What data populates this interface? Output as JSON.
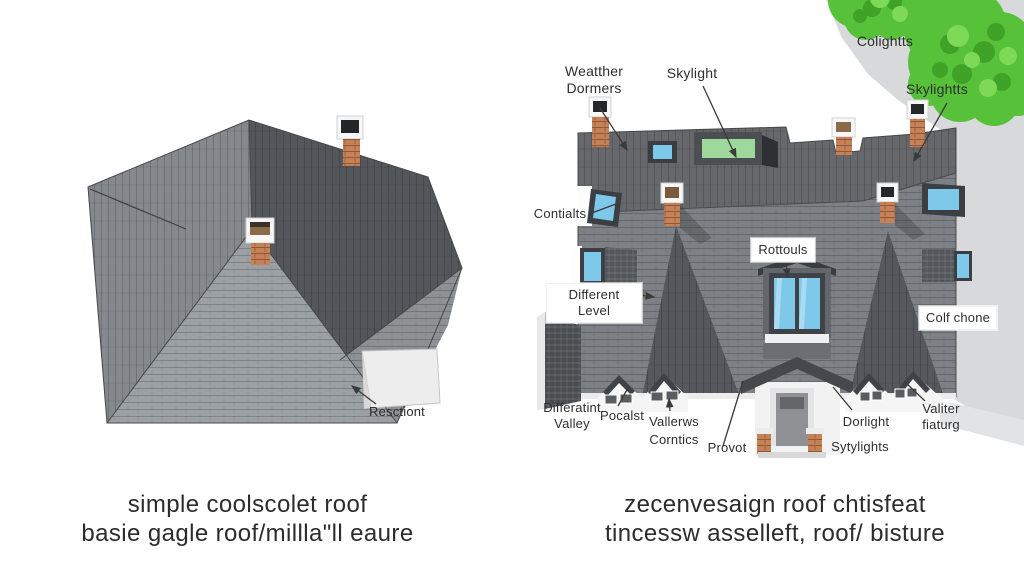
{
  "colors": {
    "background": "#ffffff",
    "roof_dark": "#54575b",
    "roof_medium": "#7d8084",
    "roof_light": "#9aa0a4",
    "roof_top_band": "#66686b",
    "chimney_brick": "#c58157",
    "window_blue": "#7ec8ea",
    "skylight_green": "#9fd89b",
    "tree_green": "#58c13a",
    "backdrop_gray": "#d8d9da",
    "label_text": "#2e2e2e"
  },
  "left_panel": {
    "annotation_resctiont": "Resctiont",
    "caption": [
      "simple coolscolet roof",
      "basie gagle roof/millla\"ll  eaure"
    ]
  },
  "right_panel": {
    "labels": {
      "weather_dormers": [
        "Weatther",
        "Dormers"
      ],
      "skylight": "Skylight",
      "colightts": "Colightts",
      "skylightts": "Skylightts",
      "contialts": "Contialts",
      "different_level": "Different Level",
      "rottouls": "Rottouls",
      "colf_chone": "Colf chone",
      "differatint_valley": [
        "Differatint",
        "Valley"
      ],
      "pocalst": "Pocalst",
      "vallerws": "Vallerws",
      "corntics": "Corntics",
      "provot": "Provot",
      "dorlight": "Dorlight",
      "sytylights": "Sytylights",
      "valiter_fiaturg": [
        "Valiter",
        "fiaturg"
      ]
    },
    "caption": [
      "zecenvesaign roof chtisfeat",
      "tincessw asselleft, roof/  bisture"
    ]
  }
}
